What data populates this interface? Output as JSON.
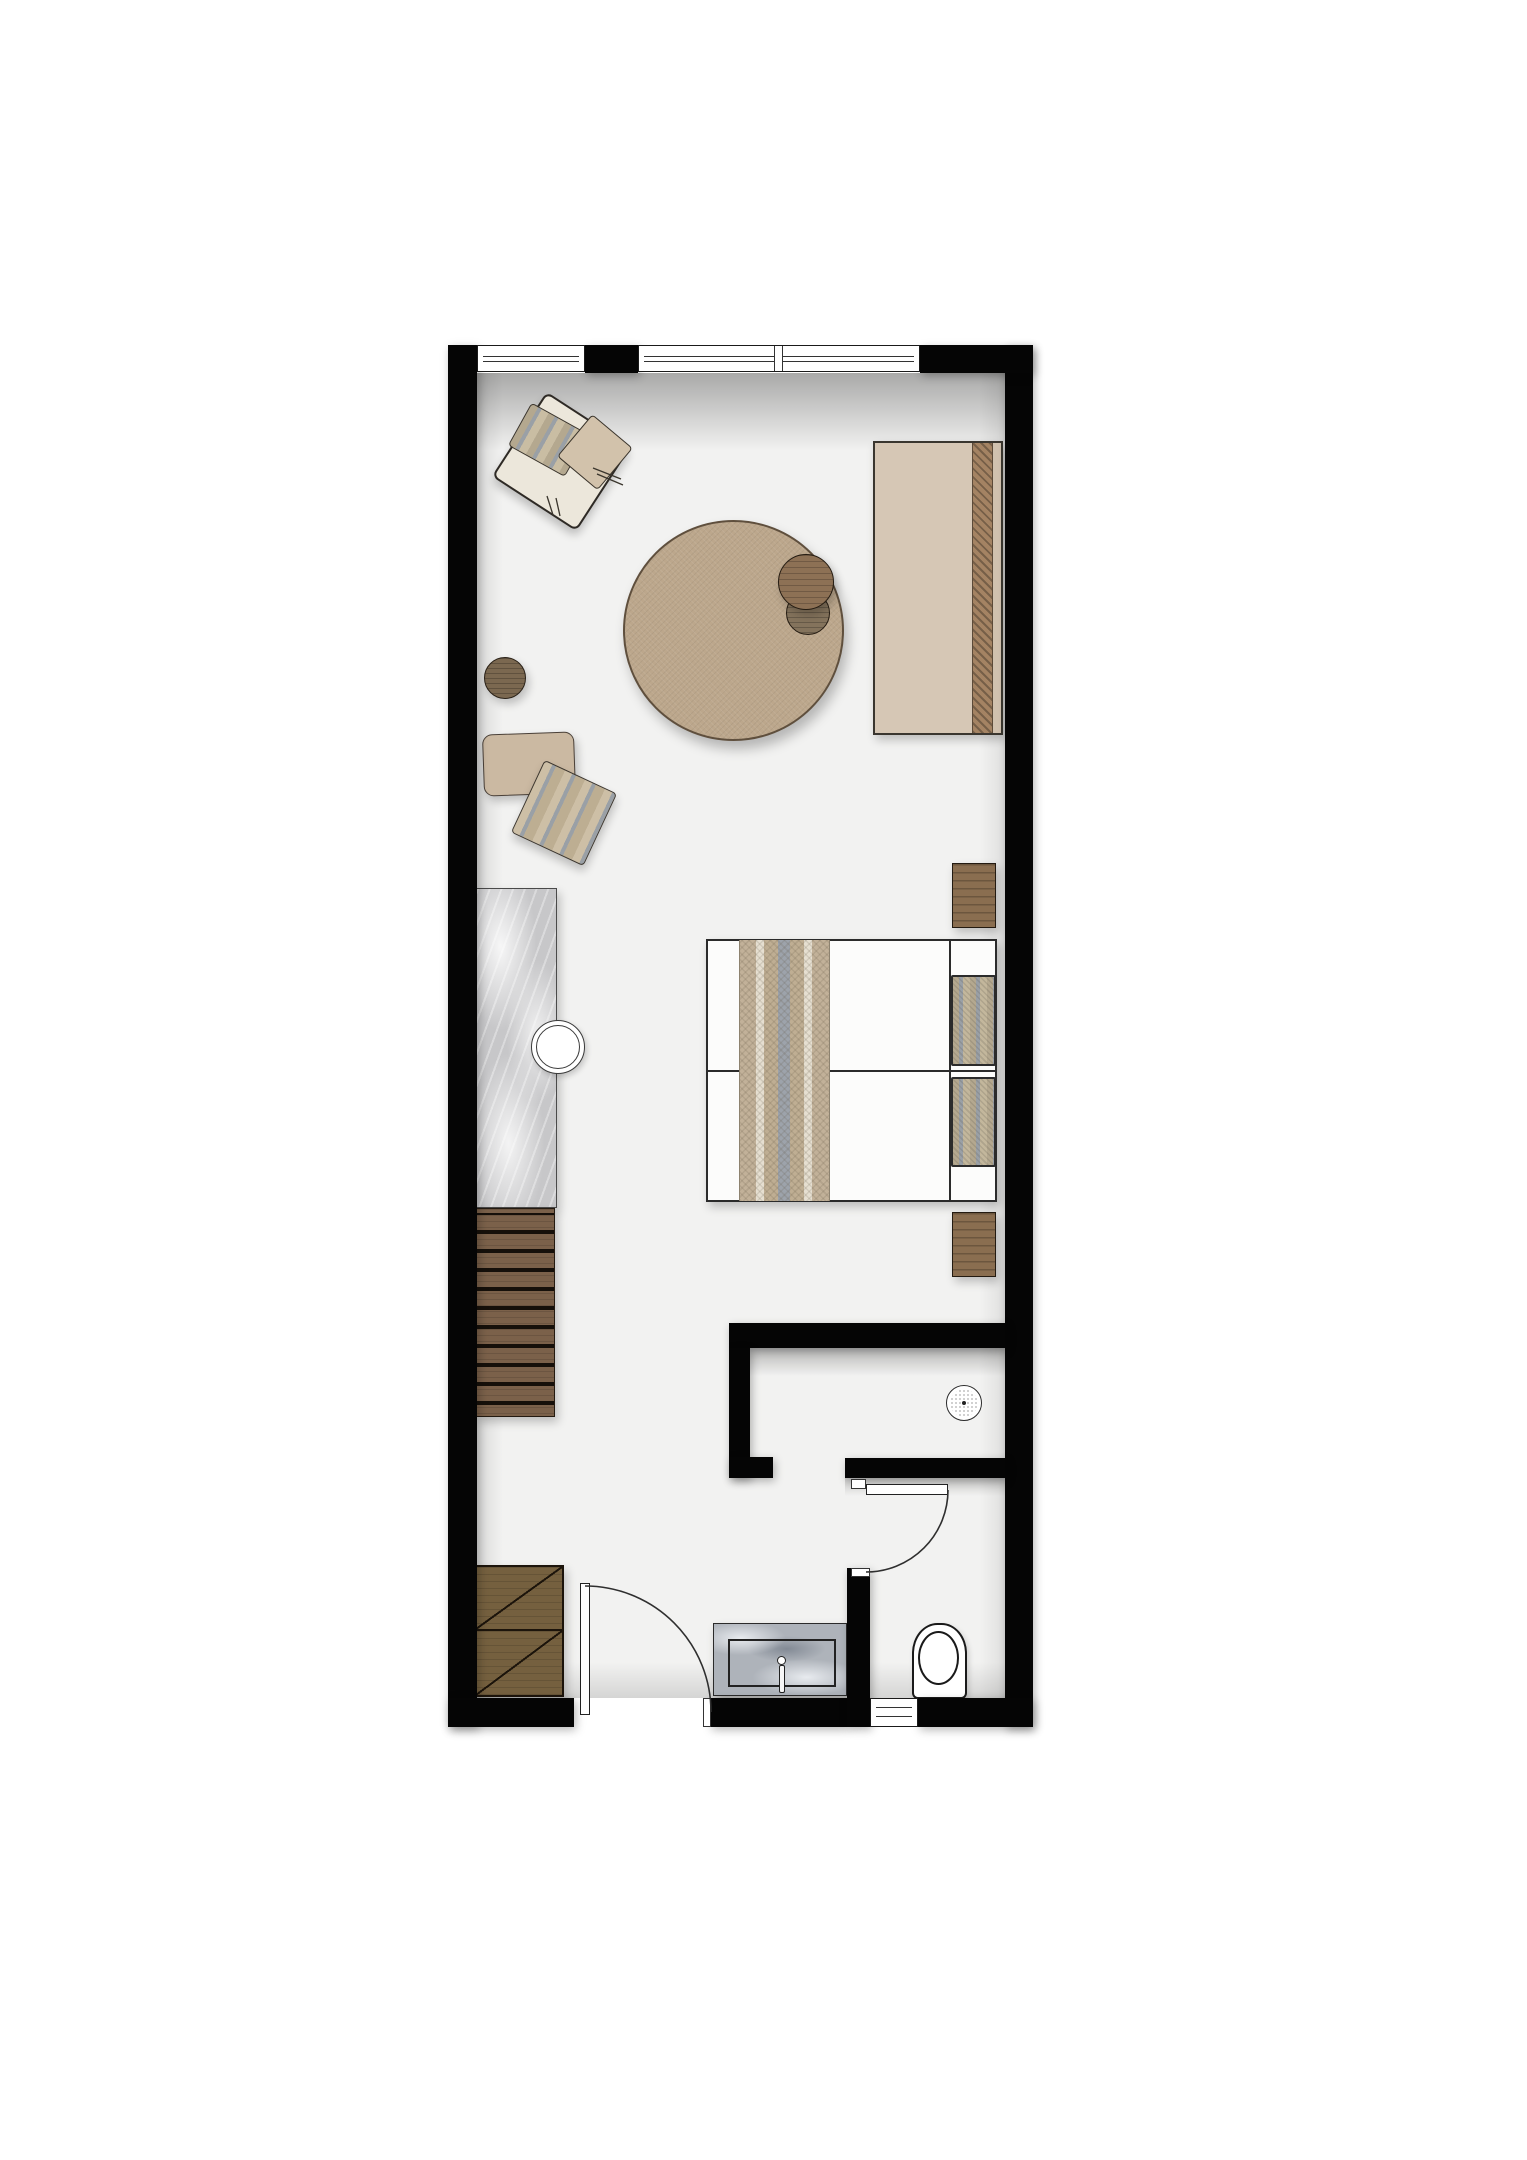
{
  "document": {
    "type": "architectural-floor-plan",
    "title": "Hotel guest room floor plan (top-down view)",
    "visible_text": []
  },
  "palette": {
    "wall": "#050505",
    "floor": "#f2f2f1",
    "page": "#ffffff",
    "outline": "#2b2b2b",
    "cream": "#ece7db",
    "beige": "#d2c2ab",
    "tan": "#bca78c",
    "wood": "#8d7155",
    "slatwood": "#7b614a",
    "wardrobe": "#75603f",
    "marble": "#c7c7c9",
    "bluemarble": "#aeb3ba",
    "runner": "#a48363",
    "daybed": "#d6c7b5",
    "nightstand": "#8a6e50"
  },
  "rooms": [
    {
      "name": "main-room",
      "contents": "lounge chair, round pouf, side tables, stool, floor cushions, daybed, twin beds, nightstands, marble counter with sink, slatted bench, wardrobe"
    },
    {
      "name": "shower-room",
      "contents": "ceiling shower head"
    },
    {
      "name": "wc-area",
      "contents": "vanity with basin and faucet, toilet"
    }
  ],
  "openings": [
    {
      "name": "window-top-left",
      "type": "window"
    },
    {
      "name": "window-top-right",
      "type": "double window with center mullion"
    },
    {
      "name": "window-bottom",
      "type": "small window"
    },
    {
      "name": "entry-door",
      "type": "swing door, hinged at bottom wall"
    },
    {
      "name": "bathroom-door",
      "type": "swing door into WC area"
    }
  ],
  "furniture": [
    {
      "name": "lounge-chair",
      "kind": "armchair with patterned and plain pillows"
    },
    {
      "name": "round-pouf",
      "kind": "large circular ottoman"
    },
    {
      "name": "side-table-large",
      "kind": "round wood table"
    },
    {
      "name": "side-table-small",
      "kind": "round wood table"
    },
    {
      "name": "stool",
      "kind": "round wood stool"
    },
    {
      "name": "floor-cushion-square",
      "kind": "beige cushion"
    },
    {
      "name": "floor-cushion-diamond",
      "kind": "patterned cushion rotated"
    },
    {
      "name": "daybed",
      "kind": "bench/daybed with woven runner"
    },
    {
      "name": "twin-beds",
      "kind": "two beds with shared striped throw and two pillows"
    },
    {
      "name": "nightstand-upper",
      "kind": "wood cube"
    },
    {
      "name": "nightstand-lower",
      "kind": "wood cube"
    },
    {
      "name": "marble-counter",
      "kind": "counter with round basin"
    },
    {
      "name": "slatted-bench",
      "kind": "wood slat unit"
    },
    {
      "name": "wardrobe",
      "kind": "two-cell closet with diagonal door marks"
    }
  ],
  "fixtures": [
    {
      "name": "shower-head",
      "kind": "round perforated shower symbol"
    },
    {
      "name": "vanity",
      "kind": "blue-gray marble top with rectangular basin and faucet"
    },
    {
      "name": "toilet",
      "kind": "toilet with oval bowl"
    },
    {
      "name": "sink",
      "kind": "round double-ring basin"
    }
  ]
}
